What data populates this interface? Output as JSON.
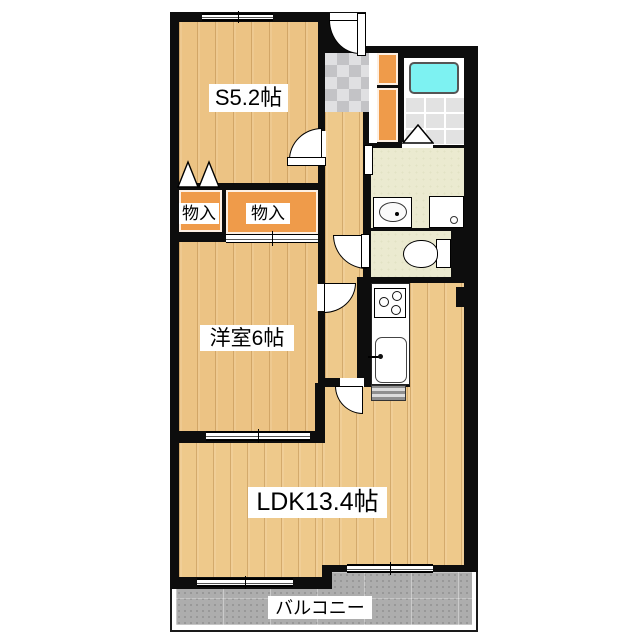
{
  "floorplan": {
    "title": "apartment-floor-plan",
    "rooms": {
      "service_room": {
        "label": "S5.2帖"
      },
      "storage_left": {
        "label": "物入"
      },
      "storage_right": {
        "label": "物入"
      },
      "western_room": {
        "label": "洋室6帖"
      },
      "ldk": {
        "label": "LDK13.4帖"
      },
      "balcony": {
        "label": "バルコニー"
      }
    },
    "fixtures": [
      "entrance-door",
      "shoe-cabinet",
      "bathtub",
      "bathroom-folding-door",
      "wash-basin",
      "washing-machine-pan",
      "toilet",
      "gas-stove",
      "kitchen-sink",
      "counter-appliance",
      "closet-bifold-door",
      "closet-sliding-door"
    ],
    "colors": {
      "wall": "#0d0d0d",
      "wood_floor": "#eec98b",
      "closet_orange": "#ef9b4a",
      "washroom_cream": "#ebead0",
      "bathtub_cyan": "#7df2f2",
      "bath_tile": "#e2e2e2",
      "genkan_tile": "#c9c9cc",
      "balcony_gray": "#adadad",
      "background": "#ffffff"
    }
  }
}
